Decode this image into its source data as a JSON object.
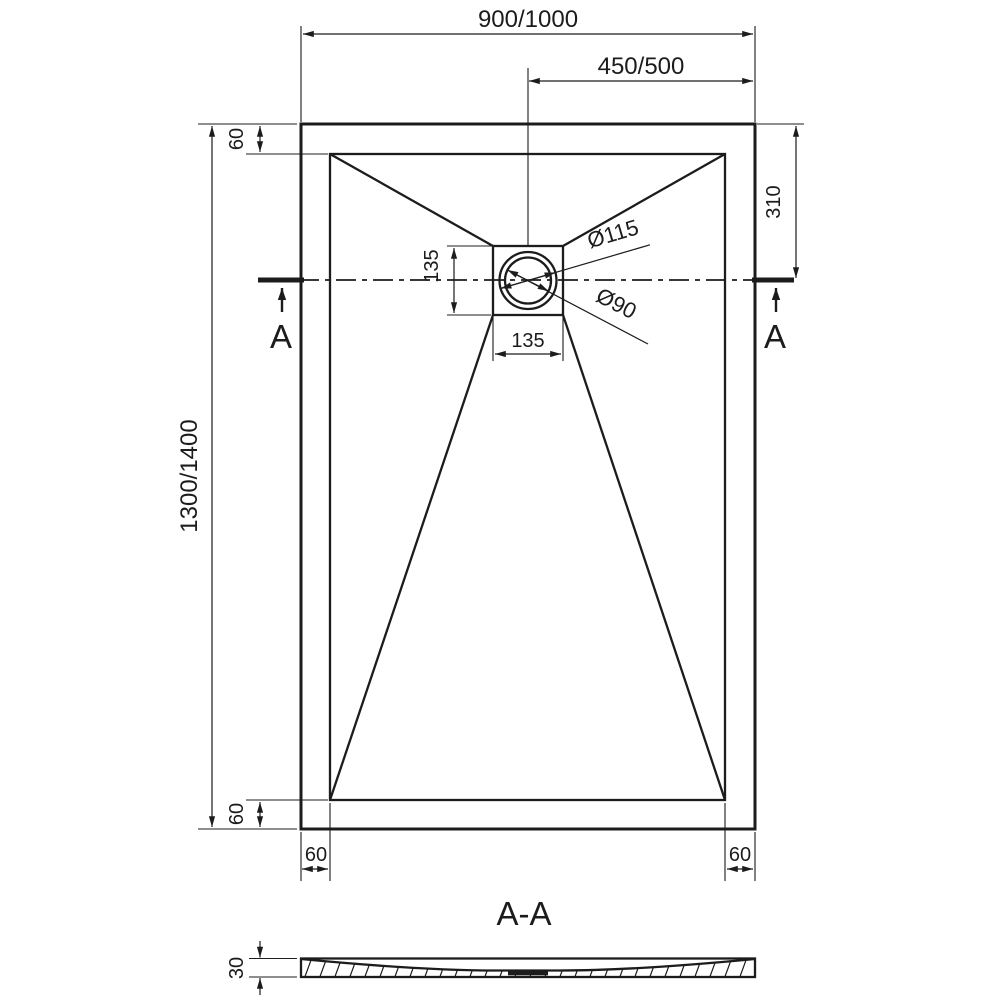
{
  "plan": {
    "dim_overall_width": "900/1000",
    "dim_center_to_right": "450/500",
    "dim_overall_length": "1300/1400",
    "dim_rim_top": "60",
    "dim_drain_offset_top": "310",
    "dim_drain_box_height": "135",
    "dim_drain_box_width": "135",
    "dim_drain_outer_dia": "Ø115",
    "dim_drain_inner_dia": "Ø90",
    "dim_rim_bottom": "60",
    "dim_rim_left": "60",
    "dim_rim_right": "60",
    "cut_label_left": "A",
    "cut_label_right": "A"
  },
  "section": {
    "title": "A-A",
    "dim_thickness": "30"
  },
  "colors": {
    "line": "#1c1c1c",
    "background": "#ffffff"
  }
}
